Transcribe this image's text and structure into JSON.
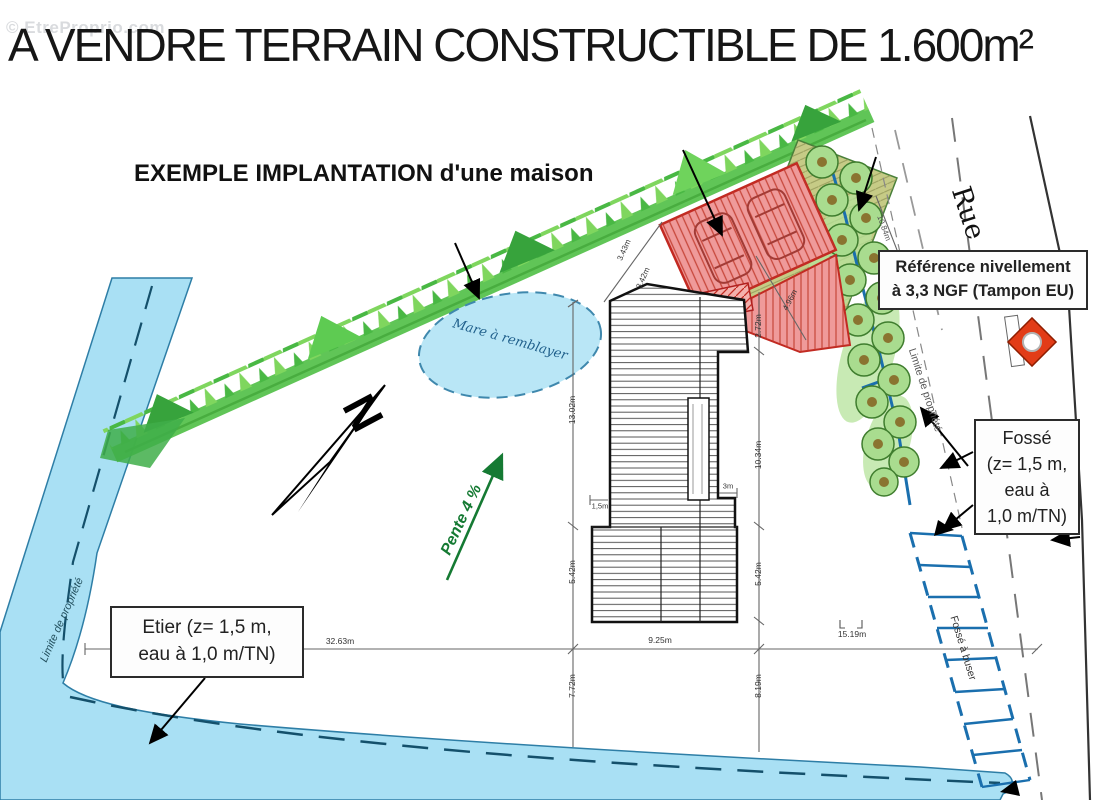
{
  "watermark": "© EtreProprio.com",
  "title": "A VENDRE TERRAIN CONSTRUCTIBLE DE 1.600m²",
  "subtitle": "EXEMPLE IMPLANTATION d'une maison",
  "plan": {
    "labels": {
      "north": "N",
      "pond": "Mare à remblayer",
      "slope": "Pente 4 %",
      "street": "Rue",
      "property_limit_left": "Limite de propriété",
      "property_limit_right": "Limite de propriété",
      "ditch_to_pipe": "Fossé à buser"
    },
    "callouts": {
      "reference": {
        "lines": [
          "Référence nivellement",
          "à 3,3 NGF (Tampon EU)"
        ]
      },
      "fosse": {
        "lines": [
          "Fossé",
          "(z= 1,5 m,",
          "eau à",
          "1,0 m/TN)"
        ]
      },
      "etier": {
        "lines": [
          "Etier (z= 1,5 m,",
          "eau à 1,0 m/TN)"
        ]
      }
    },
    "dimensions": {
      "bottom_left": "32.63m",
      "bottom_center": "9.25m",
      "bottom_right": "15.19m",
      "depth_left": "7.72m",
      "depth_right": "8.19m",
      "house_left": "13.02m",
      "house_right_top": "2.72m",
      "house_right_mid": "10.34m",
      "house_right_low": "5.42m",
      "house_left_low": "5.42m",
      "setback_a": "3.43m",
      "setback_b": "3.42m",
      "garage_side": "4.96m",
      "road_width": "10.84m",
      "notch_left": "1,5m",
      "notch_right": "3m"
    },
    "colors": {
      "water": "#a9e0f4",
      "water_edge": "#2e7ea6",
      "hedge_green": "#4fbf45",
      "tree_fill": "#a9dc8f",
      "red_building": "#ef9a9a",
      "red_line": "#c22a22",
      "slope_green": "#157a33",
      "drain_blue": "#1a6fae",
      "marker_red": "#e23c17"
    }
  }
}
